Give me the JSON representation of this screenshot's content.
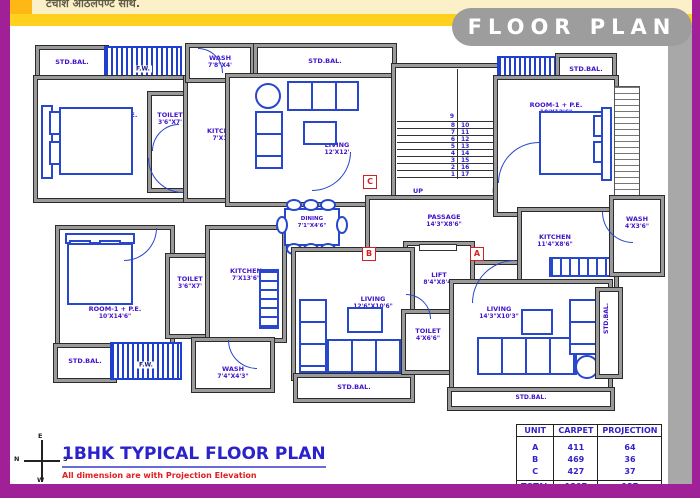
{
  "header": {
    "marathi_text": "टर्चांश आठलपण्ट साथ.",
    "title": "FLOOR PLAN"
  },
  "plan": {
    "std_bal": "STD.BAL.",
    "fw": "F.W.",
    "rooms": {
      "room_tl": {
        "name": "ROOM-1 + P.E.",
        "dim": "10'X14'"
      },
      "toilet_tl": {
        "name": "TOILET",
        "dim": "3'6\"X7'"
      },
      "kitchen_tl": {
        "name": "KITCHEN",
        "dim": "7'X10'"
      },
      "wash_t": {
        "name": "WASH",
        "dim": "7'8\"X4'"
      },
      "living_t": {
        "name": "LIVING",
        "dim": "12'X12'"
      },
      "passage": {
        "name": "PASSAGE",
        "dim": "14'3\"X8'6\""
      },
      "room_tr": {
        "name": "ROOM-1 + P.E.",
        "dim": "10'X12'6\""
      },
      "kitchen_r": {
        "name": "KITCHEN",
        "dim": "11'4\"X8'6\""
      },
      "wash_r": {
        "name": "WASH",
        "dim": "4'X3'6\""
      },
      "lift": {
        "name": "LIFT",
        "dim": "8'4\"X8'4\""
      },
      "room_bl": {
        "name": "ROOM-1 + P.E.",
        "dim": "10'X14'6\""
      },
      "toilet_bl": {
        "name": "TOILET",
        "dim": "3'6\"X7'"
      },
      "kitchen_b": {
        "name": "KITCHEN",
        "dim": "7'X13'6\""
      },
      "wash_b": {
        "name": "WASH",
        "dim": "7'4\"X4'3\""
      },
      "dining": {
        "name": "DINING",
        "dim": "7'1\"X4'6\""
      },
      "living_b": {
        "name": "LIVING",
        "dim": "12'6\"X10'6\""
      },
      "toilet_b2": {
        "name": "TOILET",
        "dim": "4'X6'6\""
      },
      "living_br": {
        "name": "LIVING",
        "dim": "14'3\"X10'3\""
      }
    },
    "stair": {
      "up": "UP",
      "dn": "DN",
      "top": "9",
      "left": [
        "8",
        "7",
        "6",
        "5",
        "4",
        "3",
        "2",
        "1"
      ],
      "right": [
        "10",
        "11",
        "12",
        "13",
        "14",
        "15",
        "16",
        "17"
      ]
    },
    "markers": {
      "a": "A",
      "b": "B",
      "c": "C"
    }
  },
  "footer": {
    "title": "1BHK TYPICAL FLOOR PLAN",
    "subtitle": "All dimension are with Projection Elevation",
    "compass": {
      "n": "N",
      "e": "E",
      "s": "S",
      "w": "W"
    }
  },
  "table": {
    "headers": [
      "UNIT",
      "CARPET",
      "PROJECTION"
    ],
    "rows": [
      [
        "A",
        "411",
        "64"
      ],
      [
        "B",
        "469",
        "36"
      ],
      [
        "C",
        "427",
        "37"
      ]
    ],
    "total": [
      "TOTAL",
      "1307",
      "137"
    ]
  },
  "colors": {
    "frame_purple": "#a02097",
    "band_gold": "#ffd01c",
    "band_pale": "#fcf0c8",
    "pill_gray": "#9d9d9d",
    "wall_gray": "#9a9a9a",
    "label_blue": "#4012c8",
    "furniture_blue": "#2747cc",
    "marker_red": "#d42020",
    "note_red": "#e02020"
  }
}
